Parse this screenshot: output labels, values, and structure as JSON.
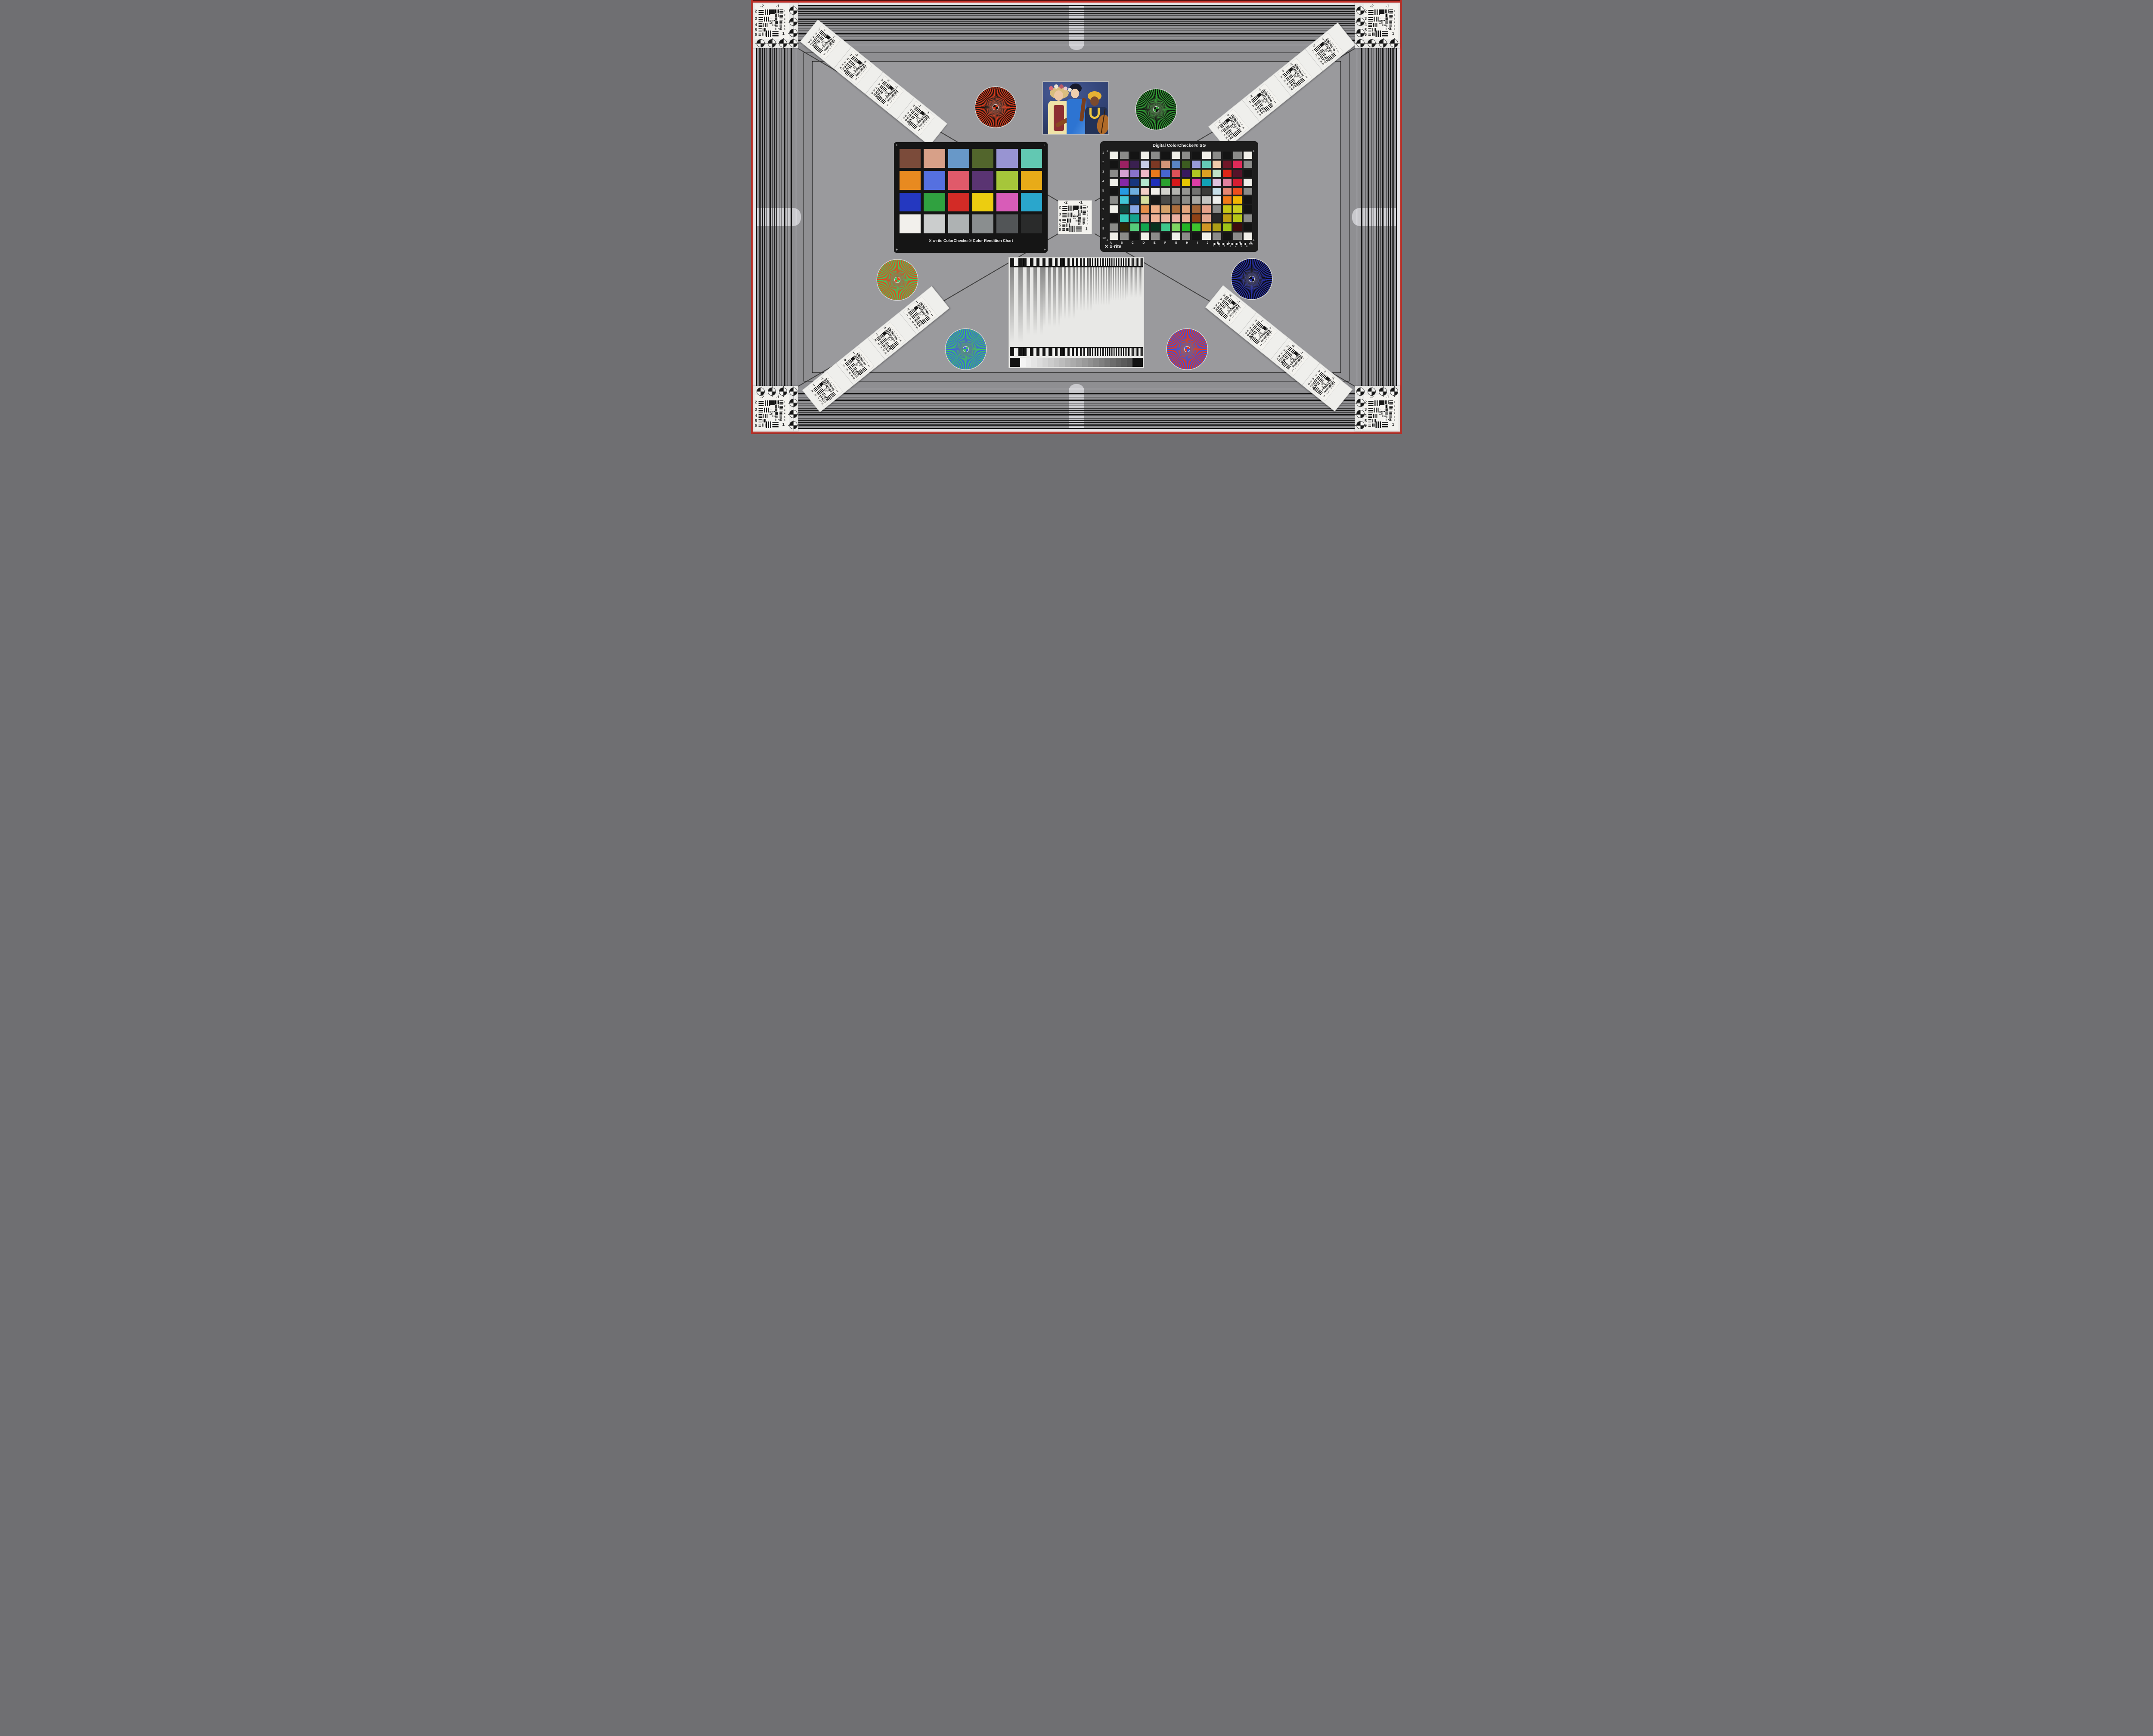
{
  "scene": {
    "kind": "camera-resolution-and-color-test-chart"
  },
  "frame": {
    "edge_red": "#c8342c",
    "band_line": "#161616",
    "margin_white": "#e7e7ea",
    "outer_gray": "#8f8f92",
    "inner_gray": "#9a9a9d",
    "pill_gray": "#c9c9cd"
  },
  "usaf_chart": {
    "top_labels": [
      "-2",
      "-1"
    ],
    "left_labels": [
      "2",
      "3",
      "4",
      "5",
      "6"
    ],
    "right_labels": [
      "1",
      "2",
      "3",
      "4",
      "5",
      "6"
    ],
    "bottom_right_labels": [
      "-2",
      "1"
    ],
    "micro_labels": [
      "0",
      "1"
    ]
  },
  "colorchecker_classic": {
    "brand_mark": "✕",
    "label": "x-rite ColorChecker® Color Rendition Chart",
    "registration_mark": "+",
    "patches": [
      "#7b4b3a",
      "#d7a088",
      "#6898c8",
      "#52652c",
      "#9894d2",
      "#62c8b2",
      "#e88a20",
      "#5570e0",
      "#e05a6a",
      "#5a3472",
      "#a6c63a",
      "#e8ab18",
      "#2438c0",
      "#30a140",
      "#d32b26",
      "#eccd10",
      "#d85cb8",
      "#2aa6cc",
      "#f2f0ec",
      "#cbcdcd",
      "#aeb2b3",
      "#8a8e8f",
      "#525557",
      "#2a2b2b"
    ]
  },
  "colorchecker_sg": {
    "title": "Digital ColorChecker® SG",
    "brand_mark": "✕",
    "brand": "x-rite",
    "registration_mark": "+",
    "row_labels": [
      "1",
      "2",
      "3",
      "4",
      "5",
      "6",
      "7",
      "8",
      "9",
      "10"
    ],
    "col_labels": [
      "A",
      "B",
      "C",
      "D",
      "E",
      "F",
      "G",
      "H",
      "I",
      "J",
      "K",
      "L",
      "M",
      "N"
    ],
    "ruler_numbers": [
      "0",
      "1",
      "2",
      "3",
      "4",
      "5",
      "6"
    ],
    "ruler_unit": "mm",
    "patches": [
      [
        "#f0efe9",
        "#8b8b89",
        "#141414",
        "#f0efe9",
        "#8b8b89",
        "#141414",
        "#f0efe9",
        "#8b8b89",
        "#141414",
        "#f0efe9",
        "#8b8b89",
        "#141414",
        "#8b8b89",
        "#f0efe9"
      ],
      [
        "#141414",
        "#9b2162",
        "#3a2050",
        "#c6cde6",
        "#7c3824",
        "#d29478",
        "#5a84c2",
        "#3c5c20",
        "#989ad8",
        "#64c8b6",
        "#eec9a9",
        "#701628",
        "#df2a58",
        "#8b8b89"
      ],
      [
        "#8b8b89",
        "#d5a2d1",
        "#8a72ca",
        "#edb8c6",
        "#e87a1c",
        "#4766ce",
        "#dd5259",
        "#38195e",
        "#afc922",
        "#dda022",
        "#c0e2c6",
        "#dd2618",
        "#561229",
        "#141414"
      ],
      [
        "#f0efe9",
        "#8628a6",
        "#17367e",
        "#b4e6ce",
        "#2030ba",
        "#2aa12e",
        "#d6181a",
        "#e6c602",
        "#dd3ea6",
        "#12a2b6",
        "#dec2de",
        "#e2809e",
        "#d61e32",
        "#f0efe9"
      ],
      [
        "#141414",
        "#269ae2",
        "#6eaede",
        "#f1cec6",
        "#f0eee9",
        "#d3d3cd",
        "#b5b5b1",
        "#959591",
        "#737371",
        "#3b3b39",
        "#c6dee9",
        "#e58672",
        "#ee4e1e",
        "#8b8b89"
      ],
      [
        "#8b8b89",
        "#42c6d6",
        "#0e2e56",
        "#d6de9e",
        "#181818",
        "#4b4b49",
        "#6b6b69",
        "#8d8d89",
        "#a8a8a4",
        "#c4c4c2",
        "#eeeeec",
        "#f07a1a",
        "#f2b602",
        "#141414"
      ],
      [
        "#f0efe9",
        "#10463e",
        "#88a8e6",
        "#e68e4a",
        "#eeae86",
        "#d6a26a",
        "#ac6e3e",
        "#e2a67e",
        "#a26436",
        "#e6a28a",
        "#8d8d8b",
        "#c6c616",
        "#cace1e",
        "#141414"
      ],
      [
        "#141414",
        "#32c6b6",
        "#14a28e",
        "#dea08e",
        "#eeb296",
        "#ecb49e",
        "#eab0a2",
        "#e8ae92",
        "#8e4216",
        "#e2a68e",
        "#282828",
        "#be9e12",
        "#b6c616",
        "#8b8b89"
      ],
      [
        "#8b8b89",
        "#2e2609",
        "#56ca7a",
        "#12a64e",
        "#08321e",
        "#3ec68a",
        "#7ed662",
        "#24b426",
        "#3ec42e",
        "#ce9624",
        "#ac9e16",
        "#9ec416",
        "#3e0c0c",
        "#141414"
      ],
      [
        "#f0efe9",
        "#8b8b89",
        "#141414",
        "#f0efe9",
        "#8b8b89",
        "#141414",
        "#f0efe9",
        "#8b8b89",
        "#141414",
        "#f0efe9",
        "#8b8b89",
        "#141414",
        "#8b8b89",
        "#f0efe9"
      ]
    ]
  },
  "starbursts": [
    {
      "id": "upper-left-red-black",
      "colors": [
        "#d23b1e",
        "#1c120e"
      ]
    },
    {
      "id": "upper-right-green-black",
      "colors": [
        "#2f9a33",
        "#0f140e"
      ]
    },
    {
      "id": "middle-left-red-green",
      "colors": [
        "#e0491f",
        "#44c45c"
      ]
    },
    {
      "id": "middle-right-blue-black",
      "colors": [
        "#2730a0",
        "#0b0b12"
      ]
    },
    {
      "id": "lower-left-green-blue",
      "colors": [
        "#3fbf63",
        "#3c64dc"
      ]
    },
    {
      "id": "lower-right-red-blue",
      "colors": [
        "#e23a1c",
        "#3a52dc"
      ]
    }
  ],
  "sweep_chart": {
    "bar_color": "#161616",
    "background": "#e8e8e6",
    "wedge_steps": [
      "#f4f4f4",
      "#ececec",
      "#e4e4e4",
      "#dcdcdc",
      "#d4d4d4",
      "#cccccc",
      "#c4c4c4",
      "#bcbcbc",
      "#b3b3b3",
      "#ababab",
      "#a3a3a3",
      "#9a9a9a",
      "#919191",
      "#888888",
      "#7f7f7f",
      "#757575",
      "#6c6c6c",
      "#636363",
      "#5a5a5a",
      "#525252"
    ]
  },
  "photo": {
    "subject": "three musicians with string instruments",
    "palette": {
      "backdrop_blue": "#35477d",
      "blouse_yellow": "#efe3a8",
      "vest_red": "#8c2f32",
      "kimono_blue": "#2d74d2",
      "headwrap_yellow": "#e6b233",
      "outfit_dark_blue": "#223258",
      "violin_brown": "#8a4a22",
      "hair_blonde": "#d9bd7e",
      "hair_black": "#171a2c"
    }
  }
}
